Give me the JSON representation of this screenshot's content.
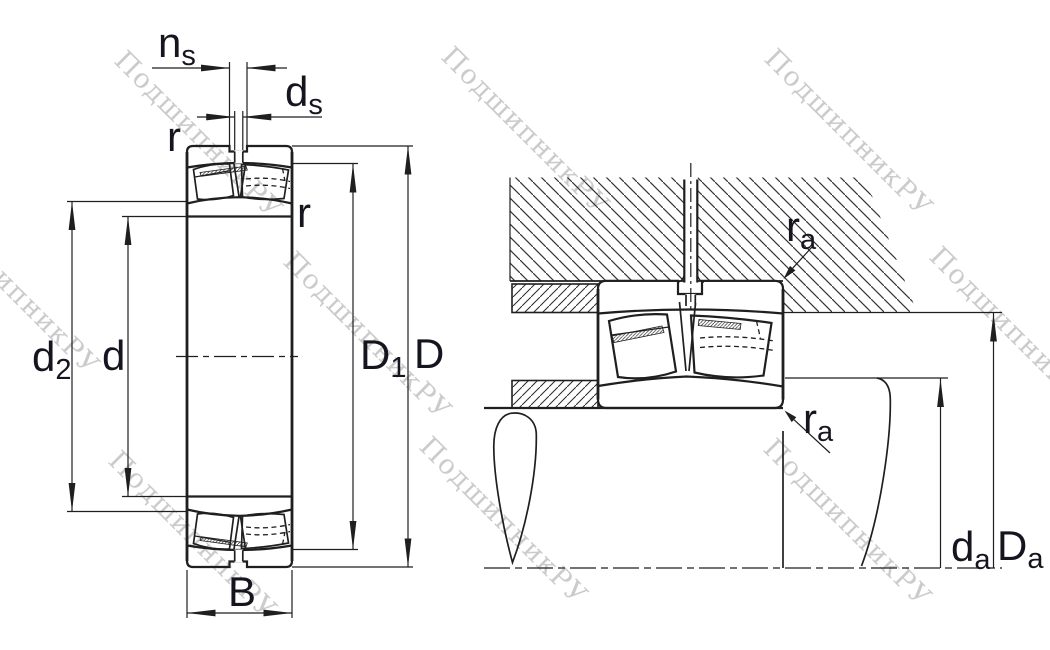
{
  "watermark": {
    "text": "ПодшипникРУ",
    "color": "#cbcbcb"
  },
  "colors": {
    "line": "#1f1f1f",
    "label": "#15151f",
    "background": "#ffffff"
  },
  "left_view": {
    "dimensions": {
      "ns": {
        "main": "n",
        "sub": "s"
      },
      "ds": {
        "main": "d",
        "sub": "s"
      },
      "r_outer": {
        "main": "r",
        "sub": ""
      },
      "r_inner": {
        "main": "r",
        "sub": ""
      },
      "d2": {
        "main": "d",
        "sub": "2"
      },
      "d": {
        "main": "d",
        "sub": ""
      },
      "D1": {
        "main": "D",
        "sub": "1"
      },
      "D": {
        "main": "D",
        "sub": ""
      },
      "B": {
        "main": "B",
        "sub": ""
      }
    }
  },
  "right_view": {
    "dimensions": {
      "ra_housing": {
        "main": "r",
        "sub": "a"
      },
      "ra_shaft": {
        "main": "r",
        "sub": "a"
      },
      "da": {
        "main": "d",
        "sub": "a"
      },
      "Da": {
        "main": "D",
        "sub": "a"
      }
    }
  }
}
